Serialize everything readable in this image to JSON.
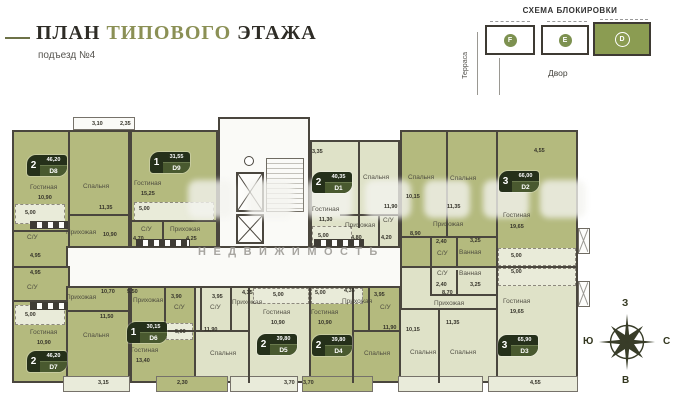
{
  "header": {
    "title_plan": "ПЛАН",
    "title_type": "ТИПОВОГО",
    "title_floor": "ЭТАЖА",
    "subtitle": "подъезд №4"
  },
  "scheme": {
    "title": "СХЕМА БЛОКИРОВКИ",
    "terrace": "Терраса",
    "yard": "Двор",
    "blocks": [
      {
        "label": "F"
      },
      {
        "label": "E"
      },
      {
        "label": "D"
      }
    ]
  },
  "compass": {
    "west": "З",
    "south": "Ю",
    "north": "С",
    "east": "В"
  },
  "watermark": {
    "line": "НЕДВИЖИМОСТЬ"
  },
  "apartments": [
    {
      "n": "2",
      "area": "46,20",
      "unit": "D8"
    },
    {
      "n": "1",
      "area": "31,55",
      "unit": "D9"
    },
    {
      "n": "2",
      "area": "40,35",
      "unit": "D1"
    },
    {
      "n": "3",
      "area": "66,00",
      "unit": "D2"
    },
    {
      "n": "2",
      "area": "46,20",
      "unit": "D7"
    },
    {
      "n": "1",
      "area": "30,15",
      "unit": "D6"
    },
    {
      "n": "2",
      "area": "39,80",
      "unit": "D5"
    },
    {
      "n": "2",
      "area": "39,80",
      "unit": "D4"
    },
    {
      "n": "3",
      "area": "65,90",
      "unit": "D3"
    }
  ],
  "plan": {
    "labels": [
      {
        "t": "3,10"
      },
      {
        "t": "2,35"
      },
      {
        "t": "Гостиная"
      },
      {
        "t": "10,90"
      },
      {
        "t": "Спальня"
      },
      {
        "t": "11,35"
      },
      {
        "t": "5,00"
      },
      {
        "t": "Прихожая"
      },
      {
        "t": "10,90"
      },
      {
        "t": "С/У"
      },
      {
        "t": "4,95"
      },
      {
        "t": "Гостиная"
      },
      {
        "t": "15,25"
      },
      {
        "t": "5,00"
      },
      {
        "t": "С/У"
      },
      {
        "t": "4,70"
      },
      {
        "t": "Прихожая"
      },
      {
        "t": "4,25"
      },
      {
        "t": "3,35"
      },
      {
        "t": "Гостиная"
      },
      {
        "t": "11,30"
      },
      {
        "t": "Спальня"
      },
      {
        "t": "11,90"
      },
      {
        "t": "Прихожая"
      },
      {
        "t": "4,80"
      },
      {
        "t": "С/У"
      },
      {
        "t": "4,20"
      },
      {
        "t": "5,00"
      },
      {
        "t": "4,55"
      },
      {
        "t": "Спальня"
      },
      {
        "t": "10,15"
      },
      {
        "t": "Спальня"
      },
      {
        "t": "11,35"
      },
      {
        "t": "Гостиная"
      },
      {
        "t": "19,65"
      },
      {
        "t": "Прихожая"
      },
      {
        "t": "8,90"
      },
      {
        "t": "2,40"
      },
      {
        "t": "С/У"
      },
      {
        "t": "Ванная"
      },
      {
        "t": "3,25"
      },
      {
        "t": "5,00"
      },
      {
        "t": "С/У"
      },
      {
        "t": "2,40"
      },
      {
        "t": "Ванная"
      },
      {
        "t": "3,25"
      },
      {
        "t": "5,00"
      },
      {
        "t": "Прихожая"
      },
      {
        "t": "8,70"
      },
      {
        "t": "Гостиная"
      },
      {
        "t": "19,65"
      },
      {
        "t": "Спальня"
      },
      {
        "t": "10,15"
      },
      {
        "t": "Спальня"
      },
      {
        "t": "11,35"
      },
      {
        "t": "4,55"
      },
      {
        "t": "4,95"
      },
      {
        "t": "С/У"
      },
      {
        "t": "Прихожая"
      },
      {
        "t": "10,70"
      },
      {
        "t": "5,00"
      },
      {
        "t": "Гостиная"
      },
      {
        "t": "10,90"
      },
      {
        "t": "Спальня"
      },
      {
        "t": "11,50"
      },
      {
        "t": "3,15"
      },
      {
        "t": "5,50"
      },
      {
        "t": "Прихожая"
      },
      {
        "t": "3,90"
      },
      {
        "t": "С/У"
      },
      {
        "t": "5,00"
      },
      {
        "t": "Гостиная"
      },
      {
        "t": "13,40"
      },
      {
        "t": "2,30"
      },
      {
        "t": "3,95"
      },
      {
        "t": "С/У"
      },
      {
        "t": "Прихожая"
      },
      {
        "t": "4,35"
      },
      {
        "t": "5,00"
      },
      {
        "t": "Гостиная"
      },
      {
        "t": "10,90"
      },
      {
        "t": "11,90"
      },
      {
        "t": "Спальня"
      },
      {
        "t": "3,70"
      },
      {
        "t": "5,00"
      },
      {
        "t": "4,35"
      },
      {
        "t": "Прихожая"
      },
      {
        "t": "3,95"
      },
      {
        "t": "С/У"
      },
      {
        "t": "Гостиная"
      },
      {
        "t": "10,90"
      },
      {
        "t": "11,90"
      },
      {
        "t": "Спальня"
      },
      {
        "t": "3,70"
      }
    ]
  }
}
